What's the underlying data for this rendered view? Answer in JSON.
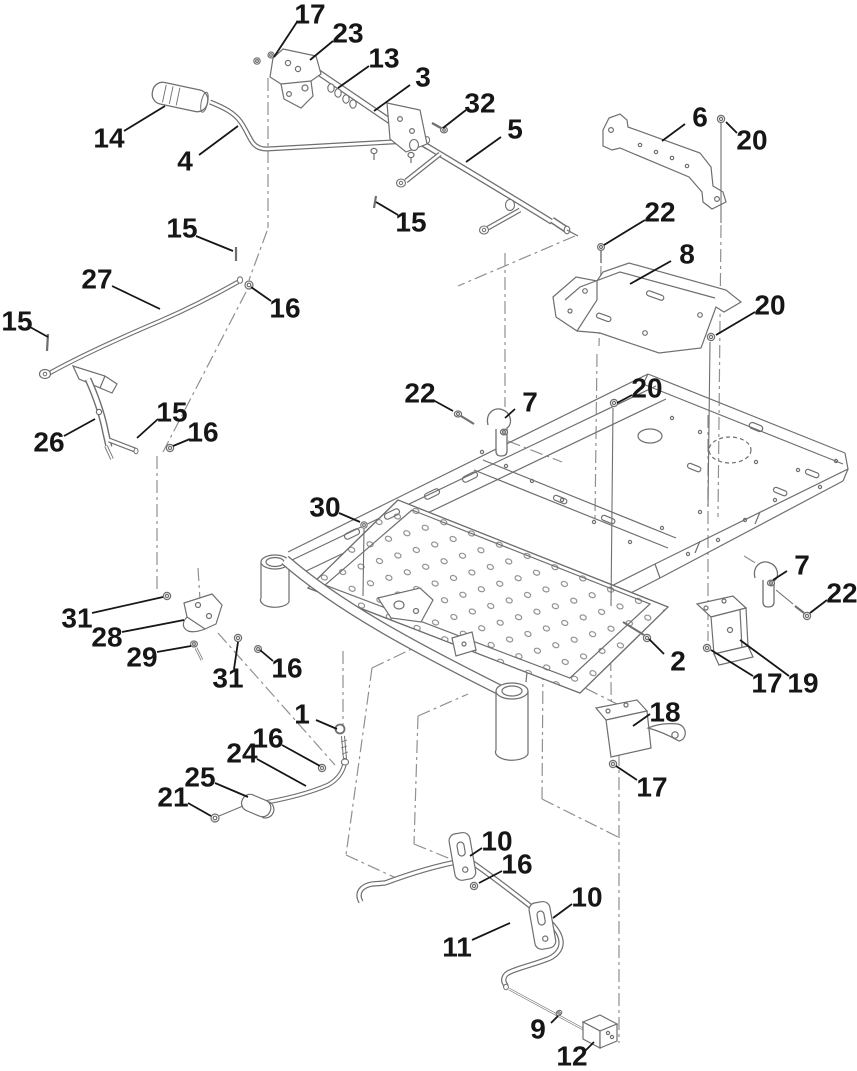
{
  "diagram": {
    "kind": "exploded-parts-diagram",
    "background": "#ffffff",
    "art_line_color": "#6f6f6f",
    "phantom_line_color": "#909090",
    "callout_color": "#161616",
    "part_numbers_visible": [
      1,
      2,
      3,
      4,
      5,
      6,
      7,
      8,
      9,
      10,
      11,
      12,
      13,
      14,
      15,
      16,
      17,
      18,
      19,
      20,
      21,
      22,
      23,
      24,
      25,
      26,
      27,
      28,
      29,
      30,
      31,
      32
    ],
    "callouts": [
      {
        "t": "17",
        "x": 310,
        "y": 14,
        "l": [
          297,
          22,
          274,
          57
        ]
      },
      {
        "t": "23",
        "x": 348,
        "y": 33,
        "l": [
          333,
          41,
          310,
          60
        ]
      },
      {
        "t": "13",
        "x": 384,
        "y": 58,
        "l": [
          369,
          66,
          338,
          88
        ]
      },
      {
        "t": "3",
        "x": 423,
        "y": 77,
        "l": [
          410,
          85,
          374,
          111
        ]
      },
      {
        "t": "32",
        "x": 480,
        "y": 103,
        "l": [
          466,
          110,
          443,
          128
        ]
      },
      {
        "t": "5",
        "x": 515,
        "y": 129,
        "l": [
          501,
          137,
          466,
          162
        ]
      },
      {
        "t": "6",
        "x": 700,
        "y": 117,
        "l": [
          685,
          124,
          662,
          141
        ]
      },
      {
        "t": "20",
        "x": 752,
        "y": 140,
        "l": [
          737,
          133,
          726,
          122
        ]
      },
      {
        "t": "14",
        "x": 109,
        "y": 138,
        "l": [
          124,
          131,
          165,
          106
        ]
      },
      {
        "t": "4",
        "x": 185,
        "y": 161,
        "l": [
          199,
          155,
          238,
          126
        ]
      },
      {
        "t": "15",
        "x": 411,
        "y": 222,
        "l": [
          398,
          215,
          376,
          202
        ]
      },
      {
        "t": "15",
        "x": 182,
        "y": 228,
        "l": [
          196,
          236,
          233,
          251
        ]
      },
      {
        "t": "16",
        "x": 285,
        "y": 308,
        "l": [
          271,
          301,
          251,
          287
        ]
      },
      {
        "t": "27",
        "x": 97,
        "y": 279,
        "l": [
          112,
          286,
          160,
          309
        ]
      },
      {
        "t": "15",
        "x": 17,
        "y": 321,
        "l": [
          30,
          327,
          48,
          337
        ]
      },
      {
        "t": "22",
        "x": 660,
        "y": 212,
        "l": [
          645,
          220,
          604,
          245
        ]
      },
      {
        "t": "8",
        "x": 687,
        "y": 254,
        "l": [
          671,
          261,
          630,
          284
        ]
      },
      {
        "t": "20",
        "x": 770,
        "y": 305,
        "l": [
          755,
          312,
          716,
          335
        ]
      },
      {
        "t": "22",
        "x": 420,
        "y": 393,
        "l": [
          433,
          400,
          453,
          411
        ]
      },
      {
        "t": "7",
        "x": 530,
        "y": 402,
        "l": [
          515,
          409,
          505,
          418
        ]
      },
      {
        "t": "20",
        "x": 647,
        "y": 388,
        "l": [
          632,
          395,
          617,
          403
        ]
      },
      {
        "t": "15",
        "x": 172,
        "y": 412,
        "l": [
          158,
          419,
          137,
          438
        ]
      },
      {
        "t": "16",
        "x": 203,
        "y": 432,
        "l": [
          190,
          439,
          173,
          446
        ]
      },
      {
        "t": "26",
        "x": 49,
        "y": 442,
        "l": [
          64,
          436,
          95,
          419
        ]
      },
      {
        "t": "30",
        "x": 325,
        "y": 507,
        "l": [
          339,
          513,
          360,
          522
        ]
      },
      {
        "t": "7",
        "x": 802,
        "y": 565,
        "l": [
          787,
          571,
          773,
          580
        ]
      },
      {
        "t": "22",
        "x": 842,
        "y": 593,
        "l": [
          827,
          600,
          810,
          613
        ]
      },
      {
        "t": "31",
        "x": 77,
        "y": 618,
        "l": [
          92,
          613,
          163,
          597
        ]
      },
      {
        "t": "28",
        "x": 107,
        "y": 637,
        "l": [
          122,
          632,
          184,
          620
        ]
      },
      {
        "t": "29",
        "x": 142,
        "y": 657,
        "l": [
          157,
          652,
          191,
          646
        ]
      },
      {
        "t": "2",
        "x": 678,
        "y": 661,
        "l": [
          664,
          654,
          649,
          639
        ]
      },
      {
        "t": "31",
        "x": 228,
        "y": 678,
        "l": [
          234,
          669,
          238,
          642
        ]
      },
      {
        "t": "16",
        "x": 287,
        "y": 668,
        "l": [
          273,
          661,
          260,
          650
        ]
      },
      {
        "t": "17",
        "x": 767,
        "y": 683,
        "l": [
          753,
          676,
          711,
          650
        ]
      },
      {
        "t": "19",
        "x": 803,
        "y": 683,
        "l": [
          789,
          676,
          740,
          640
        ]
      },
      {
        "t": "1",
        "x": 302,
        "y": 714,
        "l": [
          316,
          720,
          337,
          729
        ]
      },
      {
        "t": "18",
        "x": 665,
        "y": 712,
        "l": [
          650,
          714,
          633,
          726
        ]
      },
      {
        "t": "16",
        "x": 268,
        "y": 738,
        "l": [
          282,
          745,
          320,
          766
        ]
      },
      {
        "t": "24",
        "x": 242,
        "y": 753,
        "l": [
          257,
          759,
          306,
          786
        ]
      },
      {
        "t": "25",
        "x": 200,
        "y": 777,
        "l": [
          215,
          783,
          248,
          797
        ]
      },
      {
        "t": "17",
        "x": 652,
        "y": 787,
        "l": [
          637,
          780,
          616,
          766
        ]
      },
      {
        "t": "21",
        "x": 173,
        "y": 797,
        "l": [
          188,
          803,
          211,
          816
        ]
      },
      {
        "t": "10",
        "x": 497,
        "y": 841,
        "l": [
          482,
          848,
          470,
          856
        ]
      },
      {
        "t": "16",
        "x": 517,
        "y": 864,
        "l": [
          502,
          871,
          479,
          883
        ]
      },
      {
        "t": "10",
        "x": 587,
        "y": 897,
        "l": [
          572,
          904,
          553,
          918
        ]
      },
      {
        "t": "11",
        "x": 457,
        "y": 947,
        "l": [
          472,
          940,
          510,
          923
        ]
      },
      {
        "t": "9",
        "x": 538,
        "y": 1029,
        "l": [
          551,
          1023,
          558,
          1016
        ]
      },
      {
        "t": "12",
        "x": 572,
        "y": 1056,
        "l": [
          585,
          1051,
          594,
          1042
        ]
      }
    ]
  }
}
